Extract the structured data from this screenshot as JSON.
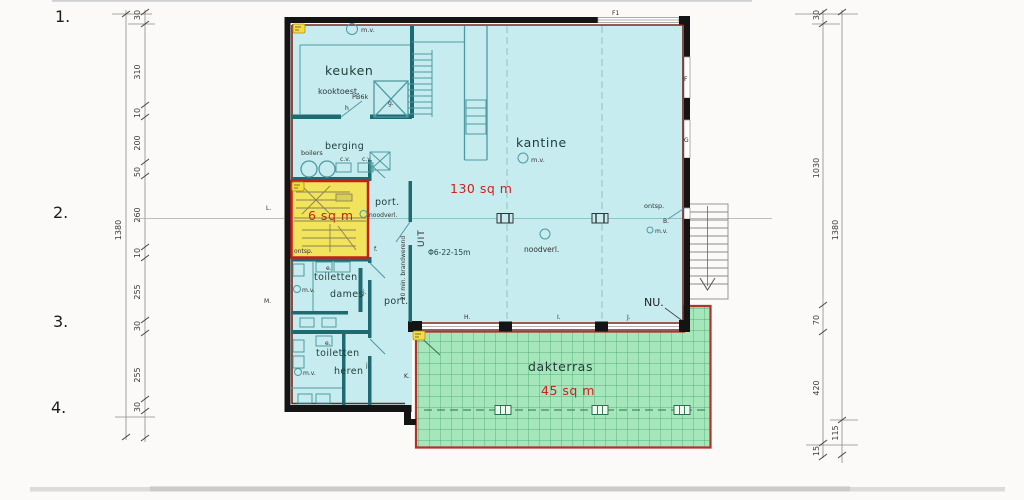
{
  "sheet": {
    "numbers": [
      "1.",
      "2.",
      "3.",
      "4."
    ]
  },
  "dimensions": {
    "left": {
      "chain": [
        "30",
        "310",
        "10",
        "200",
        "50",
        "260",
        "10",
        "255",
        "30",
        "255",
        "30"
      ],
      "total": "1380"
    },
    "right": {
      "chain": [
        "30",
        "1030",
        "70",
        "420",
        "15"
      ],
      "total": "1380",
      "outer_segment": "115"
    }
  },
  "rooms": {
    "keuken": "keuken",
    "kooktoest": "kooktoest.",
    "berging": "berging",
    "boilers": "boilers",
    "kantine": "kantine",
    "dakterras": "dakterras",
    "toiletten": "toiletten",
    "dames": "dames",
    "heren": "heren",
    "port": "port."
  },
  "areas": {
    "stairwell": "6 sq m",
    "kantine": "130 sq m",
    "dakterras": "45 sq m"
  },
  "annotations": {
    "mv": "m.v.",
    "cv": "c.v.",
    "noodverl": "noodverl.",
    "ontsp": "ontsp.",
    "extinguisher": "PB6k",
    "sprinkler": "Φ6-22-15m",
    "fire_resistant": "20 min. brandwerend",
    "exit": "UIT",
    "nu": "NU."
  },
  "tags": {
    "f1": "F1",
    "f": "F",
    "g": "G",
    "b": "B.",
    "h": "h",
    "g_door": "g.",
    "e": "e.",
    "f_door": "f.",
    "j": "j.",
    "k": "K.",
    "l": "L.",
    "m": "M.",
    "h_win": "H.",
    "i_win": "I.",
    "j_win": "J."
  },
  "colors": {
    "interior": "#c6ecef",
    "terrace": "#a5e6ba",
    "stairwell": "#f2e35d",
    "stairwell_border": "#c41f1a",
    "terrace_border": "#b2322a",
    "wall": "#141414",
    "wall_accent": "#7a241a",
    "partition": "#1d6a70",
    "area_text": "#c8231d",
    "terrace_grid": "#3f9e68"
  }
}
